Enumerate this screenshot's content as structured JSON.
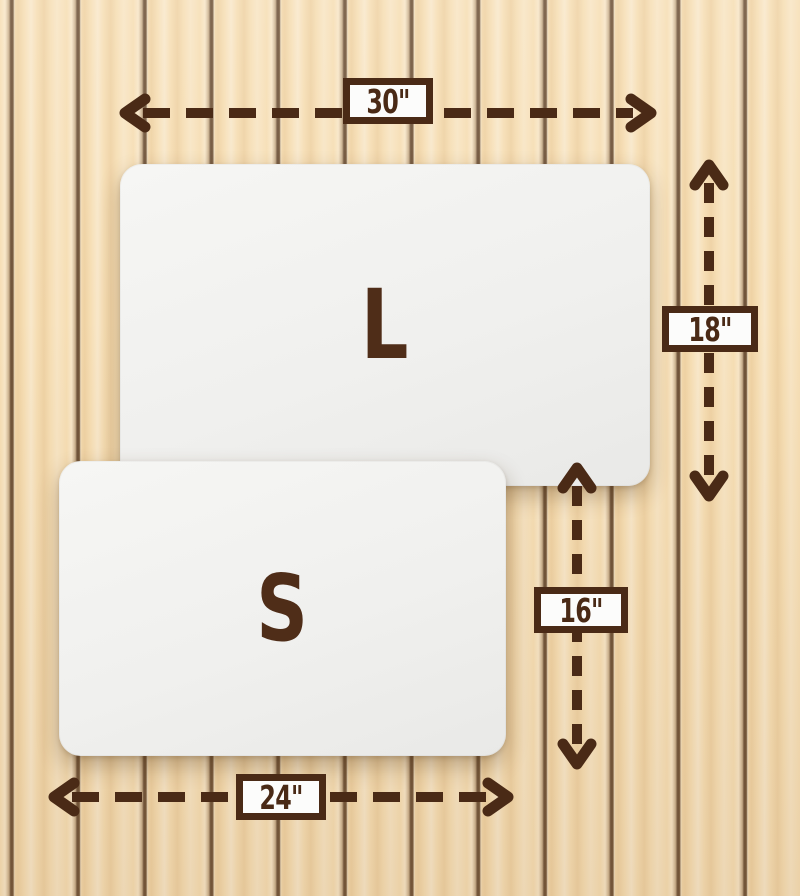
{
  "mats": {
    "large": {
      "letter": "L",
      "width": "30\"",
      "height": "18\""
    },
    "small": {
      "letter": "S",
      "width": "24\"",
      "height": "16\""
    }
  },
  "labels": {
    "large_width": "30\"",
    "large_height": "18\"",
    "small_height": "16\"",
    "small_width": "24\""
  },
  "colors": {
    "accent_brown": "#4a2a16",
    "wood_base": "#f6deb4",
    "mat_surface": "#f2f2f0"
  }
}
